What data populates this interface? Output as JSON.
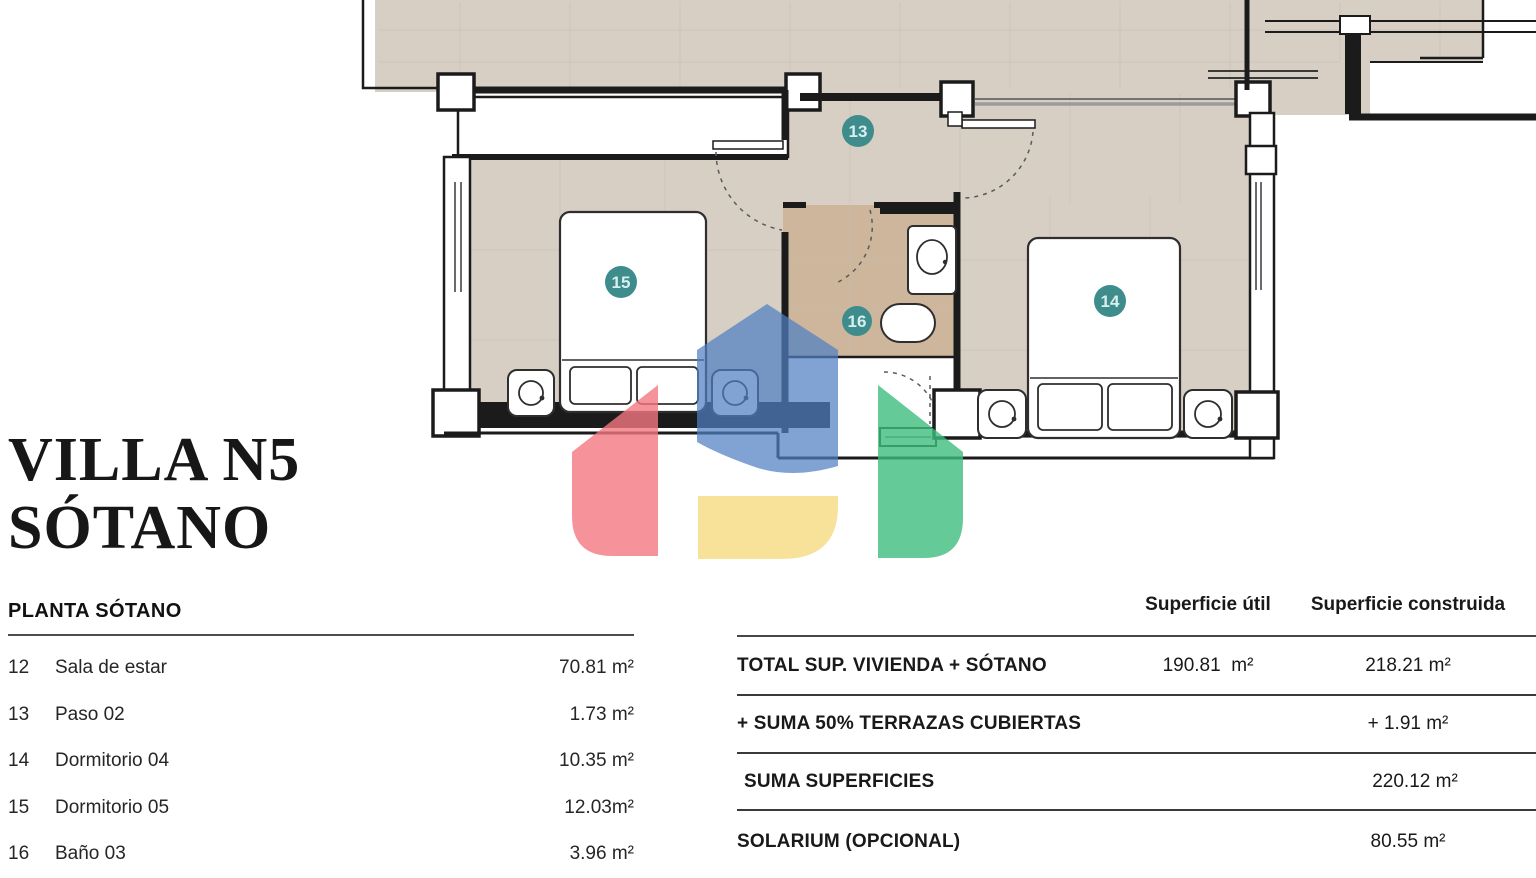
{
  "title": {
    "line1": "VILLA N5",
    "line2": "SÓTANO"
  },
  "room_table": {
    "header": "PLANTA SÓTANO",
    "rows": [
      {
        "num": "12",
        "name": "Sala de estar",
        "area": "70.81 m²"
      },
      {
        "num": "13",
        "name": "Paso 02",
        "area": "1.73 m²"
      },
      {
        "num": "14",
        "name": "Dormitorio 04",
        "area": "10.35 m²"
      },
      {
        "num": "15",
        "name": "Dormitorio 05",
        "area": "12.03m²"
      },
      {
        "num": "16",
        "name": "Baño 03",
        "area": "3.96 m²"
      }
    ]
  },
  "summary_table": {
    "col_util": "Superficie útil",
    "col_construida": "Superficie construida",
    "rows": [
      {
        "label": "TOTAL SUP. VIVIENDA + SÓTANO",
        "util": "190.81  m²",
        "construida": "218.21 m²"
      },
      {
        "label": "+ SUMA 50% TERRAZAS CUBIERTAS",
        "util": "",
        "construida": "+ 1.91 m²"
      },
      {
        "label": "SUMA SUPERFICIES",
        "util": "",
        "construida": "220.12 m²"
      },
      {
        "label": "SOLARIUM (OPCIONAL)",
        "util": "",
        "construida": "80.55 m²"
      }
    ]
  },
  "floorplan": {
    "badges": [
      {
        "label": "13"
      },
      {
        "label": "15"
      },
      {
        "label": "16"
      },
      {
        "label": "14"
      }
    ],
    "colors": {
      "floor": "#d7cfc4",
      "floor_bath": "#cdb69c",
      "wall": "#1b1b1b",
      "badge": "#3e8c8c",
      "badge_text": "#d9efef",
      "logo_red": "#f4777f",
      "logo_blue": "#4f7fc2",
      "logo_yellow": "#f7dd88",
      "logo_green": "#3dbd7d"
    }
  }
}
